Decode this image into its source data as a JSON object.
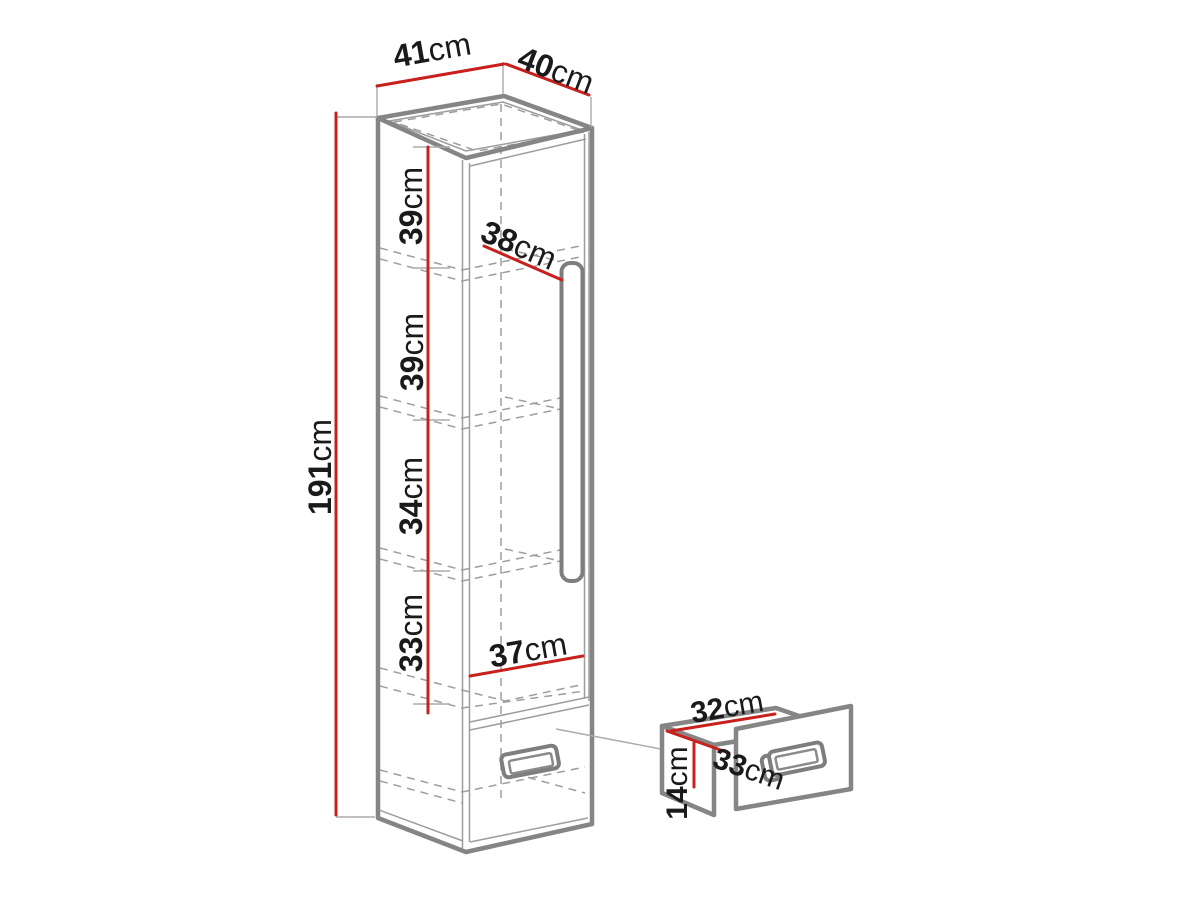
{
  "figure": {
    "type": "furniture-dimension-diagram",
    "subject": "Tall one-door wardrobe cabinet with four inner shelves and a bottom drawer, plus a detached drawer detail",
    "unit": "cm",
    "colors": {
      "dimension_line": "#c8201d",
      "outline": "#858585",
      "hidden_line": "#9d9d9d",
      "label_text": "#1a1a1a",
      "background": "#ffffff"
    },
    "cabinet": {
      "labels": {
        "top_depth": {
          "value": "41",
          "unit": "cm"
        },
        "top_width": {
          "value": "40",
          "unit": "cm"
        },
        "height": {
          "value": "191",
          "unit": "cm"
        },
        "section_1": {
          "value": "39",
          "unit": "cm"
        },
        "section_2": {
          "value": "39",
          "unit": "cm"
        },
        "section_3": {
          "value": "34",
          "unit": "cm"
        },
        "section_4": {
          "value": "33",
          "unit": "cm"
        },
        "inner_depth": {
          "value": "38",
          "unit": "cm"
        },
        "inner_width": {
          "value": "37",
          "unit": "cm"
        }
      }
    },
    "drawer": {
      "labels": {
        "width": {
          "value": "32",
          "unit": "cm"
        },
        "depth": {
          "value": "33",
          "unit": "cm"
        },
        "height": {
          "value": "14",
          "unit": "cm"
        }
      }
    }
  }
}
